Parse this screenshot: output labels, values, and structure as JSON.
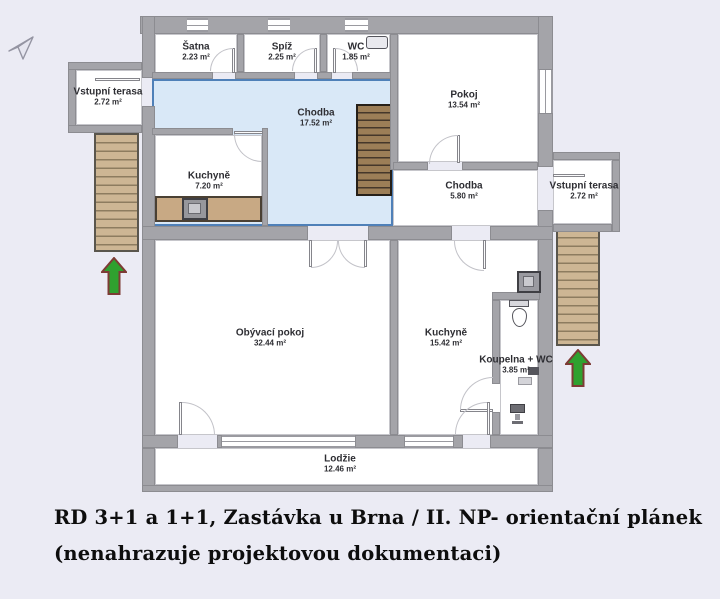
{
  "canvas": {
    "width": 720,
    "height": 599,
    "background": "#ebebf4"
  },
  "caption": {
    "line1": "RD 3+1 a 1+1, Zastávka u Brna / II. NP- orientační plánek",
    "line2": "(nenahrazuje projektovou dokumentaci)"
  },
  "colors": {
    "wall": "#a4a4a9",
    "room_fill": "#ffffff",
    "hall_fill": "#d9e8f7",
    "hall_border": "#4f80b8",
    "stairs_exterior": "#cdb694",
    "stairs_interior": "#9b7c55",
    "kitchen_counter": "#c8a984",
    "entrance_arrow": "#2fa12f",
    "entrance_arrow_outline": "#7d3b35"
  },
  "rooms": [
    {
      "id": "satna",
      "label": "Šatna",
      "area": "2.23 m²"
    },
    {
      "id": "spiz",
      "label": "Spíž",
      "area": "2.25 m²"
    },
    {
      "id": "wc",
      "label": "WC",
      "area": "1.85 m²"
    },
    {
      "id": "pokoj",
      "label": "Pokoj",
      "area": "13.54 m²"
    },
    {
      "id": "vstupni-terasa-leva",
      "label": "Vstupní terasa",
      "area": "2.72 m²"
    },
    {
      "id": "chodba-horni",
      "label": "Chodba",
      "area": "17.52 m²"
    },
    {
      "id": "kuchyne-mala",
      "label": "Kuchyně",
      "area": "7.20 m²"
    },
    {
      "id": "chodba-dolni",
      "label": "Chodba",
      "area": "5.80 m²"
    },
    {
      "id": "vstupni-terasa-prava",
      "label": "Vstupní terasa",
      "area": "2.72 m²"
    },
    {
      "id": "obyvaci-pokoj",
      "label": "Obývací pokoj",
      "area": "32.44 m²"
    },
    {
      "id": "kuchyne-velka",
      "label": "Kuchyně",
      "area": "15.42 m²"
    },
    {
      "id": "koupelna-wc",
      "label": "Koupelna + WC",
      "area": "3.85 m²"
    },
    {
      "id": "lodzie",
      "label": "Lodžie",
      "area": "12.46 m²"
    }
  ]
}
